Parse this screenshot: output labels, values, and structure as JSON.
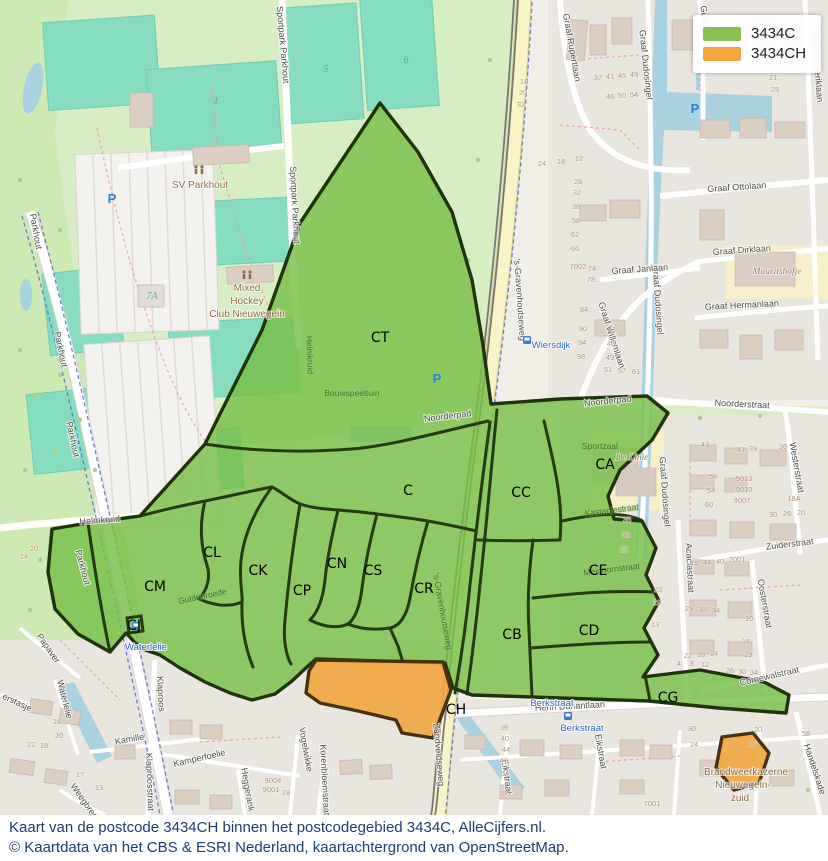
{
  "legend": {
    "items": [
      {
        "label": "3434C",
        "color": "#8CC152"
      },
      {
        "label": "3434CH",
        "color": "#F5A63F"
      }
    ]
  },
  "caption": {
    "line1": "Kaart van de postcode 3434CH binnen het postcodegebied 3434C, AlleCijfers.nl.",
    "line2": "© Kaartdata van het CBS & ESRI Nederland, kaartachtergrond van OpenStreetMap."
  },
  "overlay": {
    "green_code": "3434C",
    "orange_code": "3434CH",
    "region_labels": [
      {
        "t": "CT",
        "x": 380,
        "y": 342
      },
      {
        "t": "C",
        "x": 408,
        "y": 495
      },
      {
        "t": "CL",
        "x": 212,
        "y": 557
      },
      {
        "t": "CK",
        "x": 258,
        "y": 575
      },
      {
        "t": "CM",
        "x": 155,
        "y": 591
      },
      {
        "t": "CJ",
        "x": 134,
        "y": 630
      },
      {
        "t": "CN",
        "x": 337,
        "y": 568
      },
      {
        "t": "CS",
        "x": 373,
        "y": 575
      },
      {
        "t": "CP",
        "x": 302,
        "y": 595
      },
      {
        "t": "CR",
        "x": 424,
        "y": 593
      },
      {
        "t": "CC",
        "x": 521,
        "y": 497
      },
      {
        "t": "CA",
        "x": 605,
        "y": 469
      },
      {
        "t": "CE",
        "x": 598,
        "y": 575
      },
      {
        "t": "CB",
        "x": 512,
        "y": 639
      },
      {
        "t": "CD",
        "x": 589,
        "y": 635
      },
      {
        "t": "CG",
        "x": 668,
        "y": 702
      },
      {
        "t": "CH",
        "x": 456,
        "y": 714
      }
    ]
  },
  "map_labels": {
    "streets": [
      {
        "t": "Parkhout",
        "x": 33,
        "y": 232,
        "r": 80
      },
      {
        "t": "Parkhout",
        "x": 58,
        "y": 350,
        "r": 78
      },
      {
        "t": "Parkhout",
        "x": 70,
        "y": 440,
        "r": 78
      },
      {
        "t": "Parkhout",
        "x": 80,
        "y": 568,
        "r": 75
      },
      {
        "t": "Sportpark Parkhout",
        "x": 280,
        "y": 45,
        "r": 85
      },
      {
        "t": "Sportpark Parkhout",
        "x": 292,
        "y": 205,
        "r": 87
      },
      {
        "t": "Helmkruid",
        "x": 100,
        "y": 523,
        "r": -4
      },
      {
        "t": "Noorderpad",
        "x": 448,
        "y": 419,
        "r": -7
      },
      {
        "t": "Noorderpad",
        "x": 608,
        "y": 404,
        "r": -6
      },
      {
        "t": "Noorderstraat",
        "x": 742,
        "y": 407,
        "r": 3
      },
      {
        "t": "'s-Gravenhoutseweg",
        "x": 517,
        "y": 300,
        "r": 86
      },
      {
        "t": "Zandveldseweg",
        "x": 436,
        "y": 755,
        "r": 85
      },
      {
        "t": "Henri Dunantlaan",
        "x": 570,
        "y": 709,
        "r": -3
      },
      {
        "t": "Eikstraat",
        "x": 504,
        "y": 777,
        "r": 83
      },
      {
        "t": "Eikstraat",
        "x": 598,
        "y": 752,
        "r": 80
      },
      {
        "t": "Vogelwikke",
        "x": 303,
        "y": 750,
        "r": 80
      },
      {
        "t": "Korenbloemstraat",
        "x": 322,
        "y": 780,
        "r": 87
      },
      {
        "t": "Klaproos",
        "x": 158,
        "y": 694,
        "r": 87
      },
      {
        "t": "Klaproosstraat",
        "x": 147,
        "y": 782,
        "r": 88
      },
      {
        "t": "Kamille",
        "x": 130,
        "y": 742,
        "r": -10
      },
      {
        "t": "Kamperfoelie",
        "x": 200,
        "y": 761,
        "r": -13
      },
      {
        "t": "Heggerank",
        "x": 245,
        "y": 790,
        "r": 80
      },
      {
        "t": "Weegbree",
        "x": 82,
        "y": 803,
        "r": 55
      },
      {
        "t": "Papaver",
        "x": 46,
        "y": 650,
        "r": 55
      },
      {
        "t": "Waterlelie",
        "x": 62,
        "y": 700,
        "r": 76
      },
      {
        "t": "erstasje",
        "x": 16,
        "y": 705,
        "r": 25
      },
      {
        "t": "Graaf Rupertlaan",
        "x": 569,
        "y": 48,
        "r": 80
      },
      {
        "t": "Graaf Dudosingel",
        "x": 643,
        "y": 65,
        "r": 84
      },
      {
        "t": "Graaf Dudosingel",
        "x": 655,
        "y": 300,
        "r": 86
      },
      {
        "t": "Graaf Dudosingel",
        "x": 662,
        "y": 492,
        "r": 86
      },
      {
        "t": "Gustaaflaan",
        "x": 703,
        "y": 30,
        "r": 84
      },
      {
        "t": "Graaf Diederiklaan",
        "x": 814,
        "y": 65,
        "r": 85
      },
      {
        "t": "Graaf Ottolaan",
        "x": 737,
        "y": 190,
        "r": -4
      },
      {
        "t": "Graaf Dirklaan",
        "x": 742,
        "y": 253,
        "r": -4
      },
      {
        "t": "Graaf Janlaan",
        "x": 640,
        "y": 272,
        "r": -4
      },
      {
        "t": "Graaf Hermanlaan",
        "x": 742,
        "y": 308,
        "r": -3
      },
      {
        "t": "Graaf Willemlaan",
        "x": 609,
        "y": 336,
        "r": 72
      },
      {
        "t": "Zuiderstraat",
        "x": 790,
        "y": 547,
        "r": -7
      },
      {
        "t": "Westerstraat",
        "x": 794,
        "y": 468,
        "r": 80
      },
      {
        "t": "Acaciastraat",
        "x": 687,
        "y": 568,
        "r": 87
      },
      {
        "t": "Oosterstraat",
        "x": 762,
        "y": 604,
        "r": 80
      },
      {
        "t": "Cornewalstraat",
        "x": 770,
        "y": 679,
        "r": -13
      },
      {
        "t": "Handelskade",
        "x": 812,
        "y": 770,
        "r": 72
      }
    ],
    "overlay_streets": [
      {
        "t": "Guldenroede",
        "x": 203,
        "y": 599,
        "r": -12
      },
      {
        "t": "Kastanjestraat",
        "x": 612,
        "y": 513,
        "r": -7
      },
      {
        "t": "Meidoornstraat",
        "x": 612,
        "y": 572,
        "r": -7
      },
      {
        "t": "Helmkruid",
        "x": 307,
        "y": 355,
        "r": 88
      },
      {
        "t": "'s-Gravenhoutseweg",
        "x": 440,
        "y": 612,
        "r": 80
      },
      {
        "t": "Sportzaal",
        "x": 600,
        "y": 449,
        "r": 0
      },
      {
        "t": "Bouwspeeltuin",
        "x": 352,
        "y": 396,
        "r": 0
      }
    ],
    "transit": [
      {
        "t": "Wiersdijk",
        "x": 551,
        "y": 348,
        "r": 0
      },
      {
        "t": "Waterlelie",
        "x": 146,
        "y": 650,
        "r": 0
      },
      {
        "t": "Berkstraat",
        "x": 582,
        "y": 731,
        "r": 0
      },
      {
        "t": "Berkstraat",
        "x": 552,
        "y": 706,
        "r": 0
      }
    ],
    "poi": [
      {
        "t": "SV Parkhout",
        "x": 200,
        "y": 188
      },
      {
        "t": "Mixed",
        "x": 247,
        "y": 291
      },
      {
        "t": "Hockey",
        "x": 247,
        "y": 304
      },
      {
        "t": "Club Nieuwegein",
        "x": 247,
        "y": 317
      },
      {
        "t": "De Linie",
        "x": 632,
        "y": 460,
        "it": true
      },
      {
        "t": "Mauritshofje",
        "x": 777,
        "y": 274,
        "it": true
      },
      {
        "t": "Brandweerkazerne",
        "x": 746,
        "y": 775
      },
      {
        "t": "Nieuwegein-",
        "x": 743,
        "y": 788
      },
      {
        "t": "zuid",
        "x": 740,
        "y": 801
      }
    ],
    "house_numbers": [
      {
        "t": "37",
        "x": 598,
        "y": 80
      },
      {
        "t": "41",
        "x": 610,
        "y": 79
      },
      {
        "t": "45",
        "x": 622,
        "y": 78
      },
      {
        "t": "49",
        "x": 634,
        "y": 77
      },
      {
        "t": "46",
        "x": 610,
        "y": 99
      },
      {
        "t": "50",
        "x": 622,
        "y": 98
      },
      {
        "t": "54",
        "x": 634,
        "y": 97
      },
      {
        "t": "18",
        "x": 524,
        "y": 84
      },
      {
        "t": "20",
        "x": 523,
        "y": 95
      },
      {
        "t": "32",
        "x": 521,
        "y": 107
      },
      {
        "t": "24",
        "x": 542,
        "y": 166
      },
      {
        "t": "18",
        "x": 561,
        "y": 164
      },
      {
        "t": "12",
        "x": 579,
        "y": 161
      },
      {
        "t": "19",
        "x": 698,
        "y": 68
      },
      {
        "t": "23",
        "x": 711,
        "y": 67
      },
      {
        "t": "27",
        "x": 724,
        "y": 66
      },
      {
        "t": "17",
        "x": 771,
        "y": 68
      },
      {
        "t": "21",
        "x": 773,
        "y": 80
      },
      {
        "t": "25",
        "x": 775,
        "y": 92
      },
      {
        "t": "28",
        "x": 578,
        "y": 184
      },
      {
        "t": "32",
        "x": 577,
        "y": 195
      },
      {
        "t": "38",
        "x": 576,
        "y": 209
      },
      {
        "t": "58",
        "x": 576,
        "y": 223
      },
      {
        "t": "62",
        "x": 575,
        "y": 237
      },
      {
        "t": "66",
        "x": 575,
        "y": 251
      },
      {
        "t": "7002",
        "x": 578,
        "y": 269
      },
      {
        "t": "74",
        "x": 592,
        "y": 271
      },
      {
        "t": "78",
        "x": 591,
        "y": 282
      },
      {
        "t": "84",
        "x": 584,
        "y": 312
      },
      {
        "t": "90",
        "x": 583,
        "y": 331
      },
      {
        "t": "94",
        "x": 582,
        "y": 345
      },
      {
        "t": "98",
        "x": 581,
        "y": 359
      },
      {
        "t": "41",
        "x": 612,
        "y": 332
      },
      {
        "t": "45",
        "x": 611,
        "y": 346
      },
      {
        "t": "49",
        "x": 610,
        "y": 360
      },
      {
        "t": "51",
        "x": 608,
        "y": 372
      },
      {
        "t": "57",
        "x": 622,
        "y": 373
      },
      {
        "t": "61",
        "x": 636,
        "y": 374
      },
      {
        "t": "43",
        "x": 705,
        "y": 447
      },
      {
        "t": "41",
        "x": 741,
        "y": 452
      },
      {
        "t": "39",
        "x": 753,
        "y": 451
      },
      {
        "t": "36",
        "x": 783,
        "y": 449
      },
      {
        "t": "58",
        "x": 713,
        "y": 479
      },
      {
        "t": "54",
        "x": 711,
        "y": 493
      },
      {
        "t": "60",
        "x": 709,
        "y": 507
      },
      {
        "t": "9013",
        "x": 744,
        "y": 481
      },
      {
        "t": "9010",
        "x": 744,
        "y": 492
      },
      {
        "t": "9007",
        "x": 742,
        "y": 503
      },
      {
        "t": "30",
        "x": 773,
        "y": 517
      },
      {
        "t": "26",
        "x": 787,
        "y": 516
      },
      {
        "t": "20",
        "x": 801,
        "y": 515
      },
      {
        "t": "18A",
        "x": 794,
        "y": 501
      },
      {
        "t": "35",
        "x": 627,
        "y": 522
      },
      {
        "t": "31",
        "x": 626,
        "y": 537
      },
      {
        "t": "25",
        "x": 624,
        "y": 552
      },
      {
        "t": "23",
        "x": 658,
        "y": 592
      },
      {
        "t": "19",
        "x": 657,
        "y": 605
      },
      {
        "t": "13",
        "x": 655,
        "y": 627
      },
      {
        "t": "48",
        "x": 694,
        "y": 566
      },
      {
        "t": "44",
        "x": 707,
        "y": 565
      },
      {
        "t": "40",
        "x": 720,
        "y": 564
      },
      {
        "t": "7001",
        "x": 737,
        "y": 562
      },
      {
        "t": "29",
        "x": 689,
        "y": 611
      },
      {
        "t": "30",
        "x": 702,
        "y": 612
      },
      {
        "t": "34",
        "x": 716,
        "y": 613
      },
      {
        "t": "22",
        "x": 688,
        "y": 658
      },
      {
        "t": "18",
        "x": 701,
        "y": 657
      },
      {
        "t": "14",
        "x": 714,
        "y": 656
      },
      {
        "t": "10",
        "x": 749,
        "y": 621
      },
      {
        "t": "16",
        "x": 746,
        "y": 644
      },
      {
        "t": "19",
        "x": 748,
        "y": 657
      },
      {
        "t": "4",
        "x": 679,
        "y": 666
      },
      {
        "t": "8",
        "x": 692,
        "y": 666
      },
      {
        "t": "12",
        "x": 705,
        "y": 667
      },
      {
        "t": "26",
        "x": 730,
        "y": 673
      },
      {
        "t": "30",
        "x": 742,
        "y": 674
      },
      {
        "t": "34",
        "x": 754,
        "y": 675
      },
      {
        "t": "36",
        "x": 504,
        "y": 730
      },
      {
        "t": "40",
        "x": 505,
        "y": 741
      },
      {
        "t": "44",
        "x": 506,
        "y": 752
      },
      {
        "t": "46",
        "x": 504,
        "y": 763
      },
      {
        "t": "54",
        "x": 505,
        "y": 776
      },
      {
        "t": "60",
        "x": 506,
        "y": 796
      },
      {
        "t": "30",
        "x": 692,
        "y": 731
      },
      {
        "t": "20",
        "x": 758,
        "y": 732
      },
      {
        "t": "24",
        "x": 694,
        "y": 747
      },
      {
        "t": "16",
        "x": 753,
        "y": 746
      },
      {
        "t": "58",
        "x": 806,
        "y": 736
      },
      {
        "t": "9004",
        "x": 273,
        "y": 783
      },
      {
        "t": "9001",
        "x": 271,
        "y": 792
      },
      {
        "t": "28",
        "x": 286,
        "y": 795
      },
      {
        "t": "9007",
        "x": 740,
        "y": 802
      },
      {
        "t": "7001",
        "x": 652,
        "y": 806
      },
      {
        "t": "22",
        "x": 31,
        "y": 747
      },
      {
        "t": "18",
        "x": 44,
        "y": 748
      },
      {
        "t": "16",
        "x": 57,
        "y": 724
      },
      {
        "t": "20",
        "x": 59,
        "y": 738
      },
      {
        "t": "13",
        "x": 99,
        "y": 790
      },
      {
        "t": "17",
        "x": 80,
        "y": 777
      },
      {
        "t": "20",
        "x": 34,
        "y": 551
      },
      {
        "t": "14",
        "x": 24,
        "y": 559
      }
    ],
    "pitch_numbers": [
      {
        "t": "1",
        "x": 216,
        "y": 104
      },
      {
        "t": "5",
        "x": 326,
        "y": 72
      },
      {
        "t": "6",
        "x": 406,
        "y": 63
      },
      {
        "t": "7A",
        "x": 152,
        "y": 299
      }
    ],
    "parking_icons": [
      {
        "x": 112,
        "y": 203
      },
      {
        "x": 695,
        "y": 113
      },
      {
        "x": 437,
        "y": 383
      }
    ],
    "bus_icons": [
      {
        "x": 527,
        "y": 340
      },
      {
        "x": 136,
        "y": 626
      },
      {
        "x": 568,
        "y": 716
      }
    ],
    "sports_icons": [
      {
        "x": 199,
        "y": 170
      },
      {
        "x": 247,
        "y": 275
      }
    ]
  }
}
